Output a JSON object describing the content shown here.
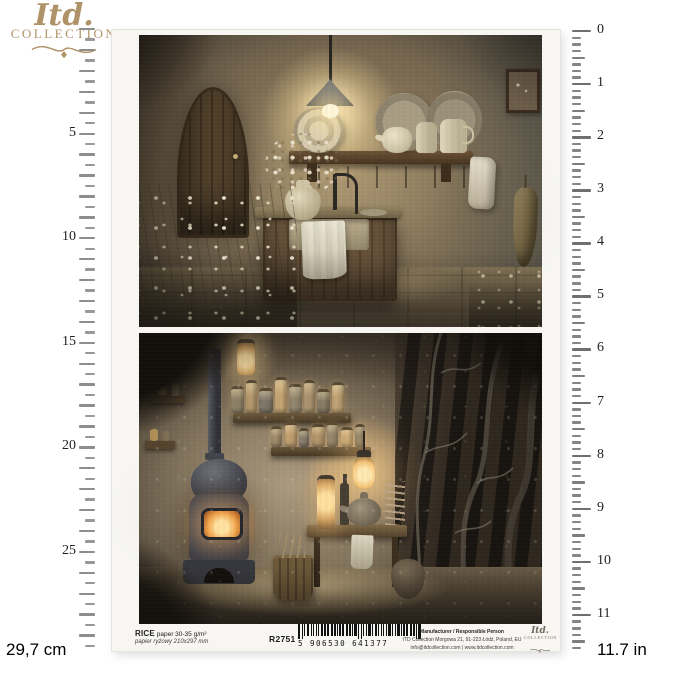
{
  "brand": {
    "script": "Itd.",
    "word": "COLLECTION"
  },
  "rulers": {
    "cm": {
      "labels": [
        "5",
        "10",
        "15",
        "20",
        "25"
      ],
      "values": [
        5,
        10,
        15,
        20,
        25
      ],
      "total": 29.7,
      "caption": "29,7 cm"
    },
    "inch": {
      "labels": [
        "0",
        "1",
        "2",
        "3",
        "4",
        "5",
        "6",
        "7",
        "8",
        "9",
        "10",
        "11"
      ],
      "values": [
        0,
        1,
        2,
        3,
        4,
        5,
        6,
        7,
        8,
        9,
        10,
        11
      ],
      "total": 11.7,
      "caption": "11.7 in"
    }
  },
  "product": {
    "name_bold": "RICE",
    "name_rest": " paper 30-35 g/m²",
    "subtitle": "papier ryżowy 210x297 mm",
    "code": "R2751",
    "barcode": "5 906530 641377",
    "manufacturer_title": "Manufacturer / Responsible Person",
    "manufacturer_address": "ITD Collection Morgowa 21, 91-223 Łódź, Poland, EU",
    "manufacturer_contact": "info@itdcollection.com | www.itdcollection.com"
  },
  "palette": {
    "brand_gold": "#b09268",
    "tick_gray": "#8d8d8d",
    "paper": "#f7f6f2",
    "art_warm_glow": "#f3d796",
    "art_dark": "#2d2720"
  }
}
